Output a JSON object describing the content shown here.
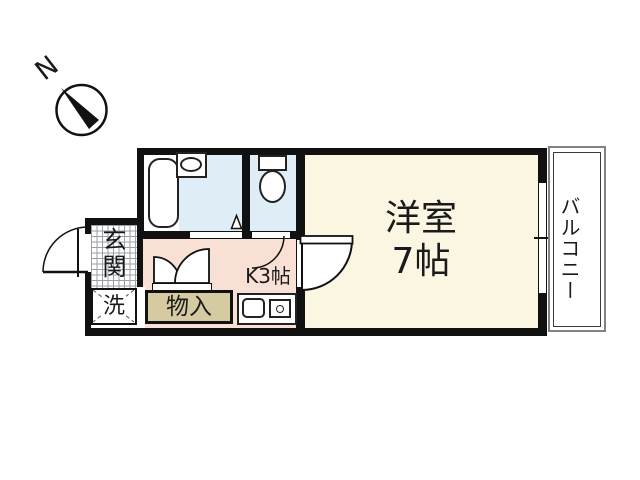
{
  "title": "1K apartment floor plan",
  "compass": {
    "north_label": "N"
  },
  "rooms": {
    "entrance": {
      "label": "玄関"
    },
    "washer": {
      "label": "洗"
    },
    "storage": {
      "label": "物入"
    },
    "kitchen": {
      "label": "K3帖"
    },
    "western_room": {
      "label": "洋室",
      "size": "7帖"
    },
    "balcony": {
      "label": "バルコニー"
    }
  },
  "colors": {
    "wall": "#111111",
    "wet_area_floor": "#dfedf6",
    "kitchen_floor": "#f9e0d4",
    "room_floor": "#faf6e2",
    "storage_fill": "#d6caa2",
    "balcony_outline": "#828282"
  }
}
